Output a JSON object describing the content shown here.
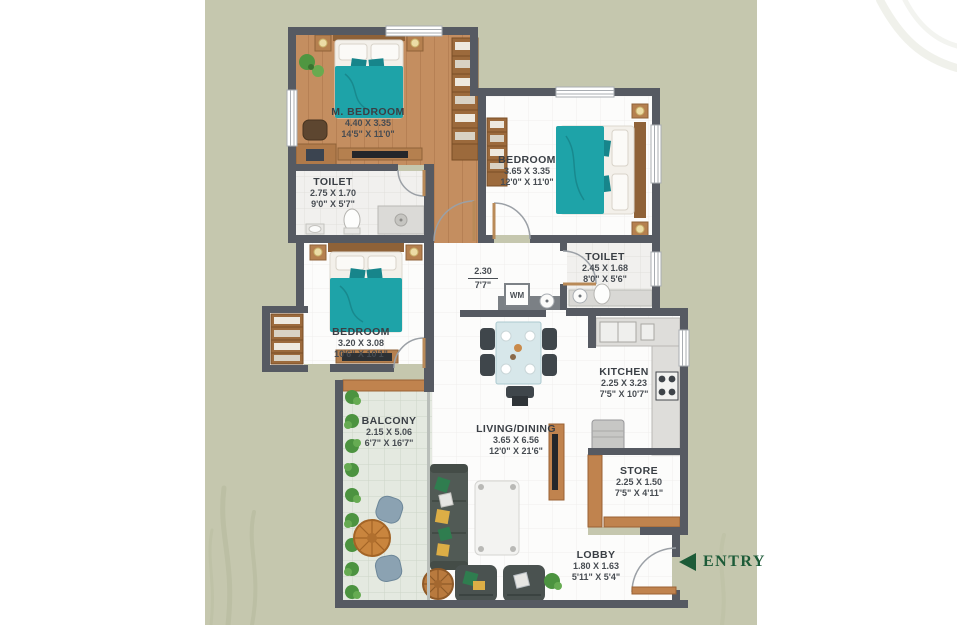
{
  "colors": {
    "background": "#ffffff",
    "panel": "#c5c7ae",
    "wall": "#565a62",
    "wood_floor": "#c48e60",
    "teal_bed": "#1ea3a8",
    "entry_green": "#1d5b38"
  },
  "entry": {
    "label": "ENTRY"
  },
  "appliances": {
    "washing_machine": "WM"
  },
  "rooms": {
    "m_bedroom": {
      "name": "M. BEDROOM",
      "dim_m": "4.40 X 3.35",
      "dim_ft": "14'5\" X 11'0\""
    },
    "toilet_master": {
      "name": "TOILET",
      "dim_m": "2.75 X 1.70",
      "dim_ft": "9'0\" X 5'7\""
    },
    "bedroom_2": {
      "name": "BEDROOM",
      "dim_m": "3.65 X 3.35",
      "dim_ft": "12'0\" X 11'0\""
    },
    "toilet_common": {
      "name": "TOILET",
      "dim_m": "2.45 X 1.68",
      "dim_ft": "8'0\" X 5'6\""
    },
    "passage": {
      "dim_m": "2.30",
      "dim_ft": "7'7\""
    },
    "bedroom_3": {
      "name": "BEDROOM",
      "dim_m": "3.20 X 3.08",
      "dim_ft": "10'6\" X 10'1\""
    },
    "balcony": {
      "name": "BALCONY",
      "dim_m": "2.15 X 5.06",
      "dim_ft": "6'7\" X 16'7\""
    },
    "living_dining": {
      "name": "LIVING/DINING",
      "dim_m": "3.65 X 6.56",
      "dim_ft": "12'0\" X 21'6\""
    },
    "kitchen": {
      "name": "KITCHEN",
      "dim_m": "2.25 X 3.23",
      "dim_ft": "7'5\" X 10'7\""
    },
    "store": {
      "name": "STORE",
      "dim_m": "2.25 X 1.50",
      "dim_ft": "7'5\" X 4'11\""
    },
    "lobby": {
      "name": "LOBBY",
      "dim_m": "1.80 X 1.63",
      "dim_ft": "5'11\" X 5'4\""
    }
  }
}
